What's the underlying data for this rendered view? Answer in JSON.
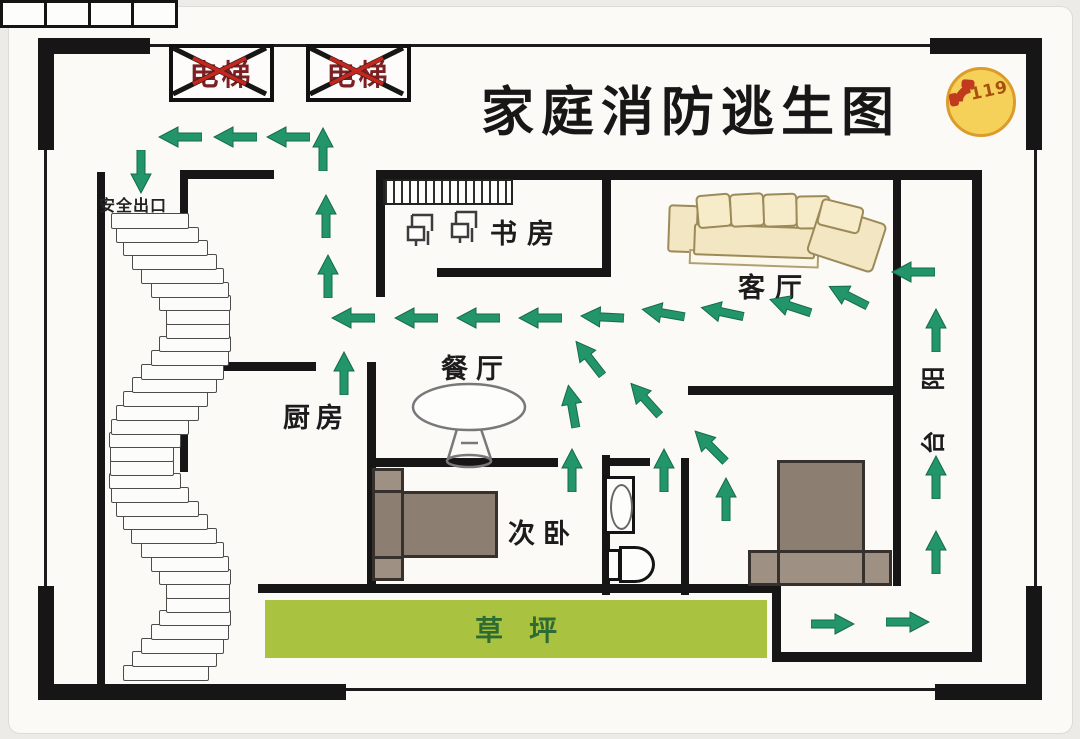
{
  "labels": {
    "title": "家庭消防逃生图",
    "elevator": "电梯",
    "safety_exit": "安全出口",
    "fire_number": "119",
    "study": "书房",
    "living_room": "客厅",
    "dining_room": "餐厅",
    "kitchen": "厨房",
    "second_bedroom": "次卧",
    "balcony": "阳台",
    "lawn": "草坪"
  },
  "balcony_chars": [
    "阳",
    "台"
  ],
  "colors": {
    "arrow_green": "#23956a",
    "lawn_green": "#a9c340",
    "lawn_text_green": "#2e6b33",
    "wall_black": "#161616",
    "elevator_text_red": "#7d2024",
    "cross_red": "#c2271d",
    "badge_yellow": "#f6d159",
    "badge_border_orange": "#db9c2b",
    "phone_red": "#c23a1d",
    "sofa_beige": "#f3e7c3",
    "bed_brown": "#8d7e72"
  },
  "stairs": {
    "steps": 34
  },
  "route_arrows": [
    {
      "x": 180,
      "y": 137,
      "deg": 180,
      "dir": "left"
    },
    {
      "x": 235,
      "y": 137,
      "deg": 180,
      "dir": "left"
    },
    {
      "x": 288,
      "y": 137,
      "deg": 180,
      "dir": "left"
    },
    {
      "x": 141,
      "y": 172,
      "deg": 90,
      "dir": "down-to-exit"
    },
    {
      "x": 323,
      "y": 149,
      "deg": -90,
      "dir": "up"
    },
    {
      "x": 326,
      "y": 216,
      "deg": -90,
      "dir": "up"
    },
    {
      "x": 328,
      "y": 276,
      "deg": -90,
      "dir": "up"
    },
    {
      "x": 353,
      "y": 318,
      "deg": 180,
      "dir": "left"
    },
    {
      "x": 416,
      "y": 318,
      "deg": 180,
      "dir": "left"
    },
    {
      "x": 478,
      "y": 318,
      "deg": 180,
      "dir": "left"
    },
    {
      "x": 540,
      "y": 318,
      "deg": 180,
      "dir": "left"
    },
    {
      "x": 602,
      "y": 317,
      "deg": 183,
      "dir": "left"
    },
    {
      "x": 663,
      "y": 313,
      "deg": 190,
      "dir": "left-down"
    },
    {
      "x": 722,
      "y": 312,
      "deg": 192,
      "dir": "left-down"
    },
    {
      "x": 790,
      "y": 306,
      "deg": 198,
      "dir": "left-down"
    },
    {
      "x": 848,
      "y": 296,
      "deg": 207,
      "dir": "left-down"
    },
    {
      "x": 913,
      "y": 272,
      "deg": 180,
      "dir": "left"
    },
    {
      "x": 936,
      "y": 330,
      "deg": -90,
      "dir": "up"
    },
    {
      "x": 572,
      "y": 406,
      "deg": -100,
      "dir": "up-left"
    },
    {
      "x": 589,
      "y": 358,
      "deg": -128,
      "dir": "up-left"
    },
    {
      "x": 645,
      "y": 399,
      "deg": -132,
      "dir": "up-left"
    },
    {
      "x": 710,
      "y": 446,
      "deg": -135,
      "dir": "up-left"
    },
    {
      "x": 664,
      "y": 470,
      "deg": -90,
      "dir": "up"
    },
    {
      "x": 726,
      "y": 499,
      "deg": -90,
      "dir": "up"
    },
    {
      "x": 572,
      "y": 470,
      "deg": -90,
      "dir": "up"
    },
    {
      "x": 344,
      "y": 373,
      "deg": -90,
      "dir": "up"
    },
    {
      "x": 936,
      "y": 477,
      "deg": -90,
      "dir": "up"
    },
    {
      "x": 936,
      "y": 552,
      "deg": -90,
      "dir": "up"
    },
    {
      "x": 833,
      "y": 624,
      "deg": 0,
      "dir": "right"
    },
    {
      "x": 908,
      "y": 622,
      "deg": 0,
      "dir": "right"
    }
  ]
}
